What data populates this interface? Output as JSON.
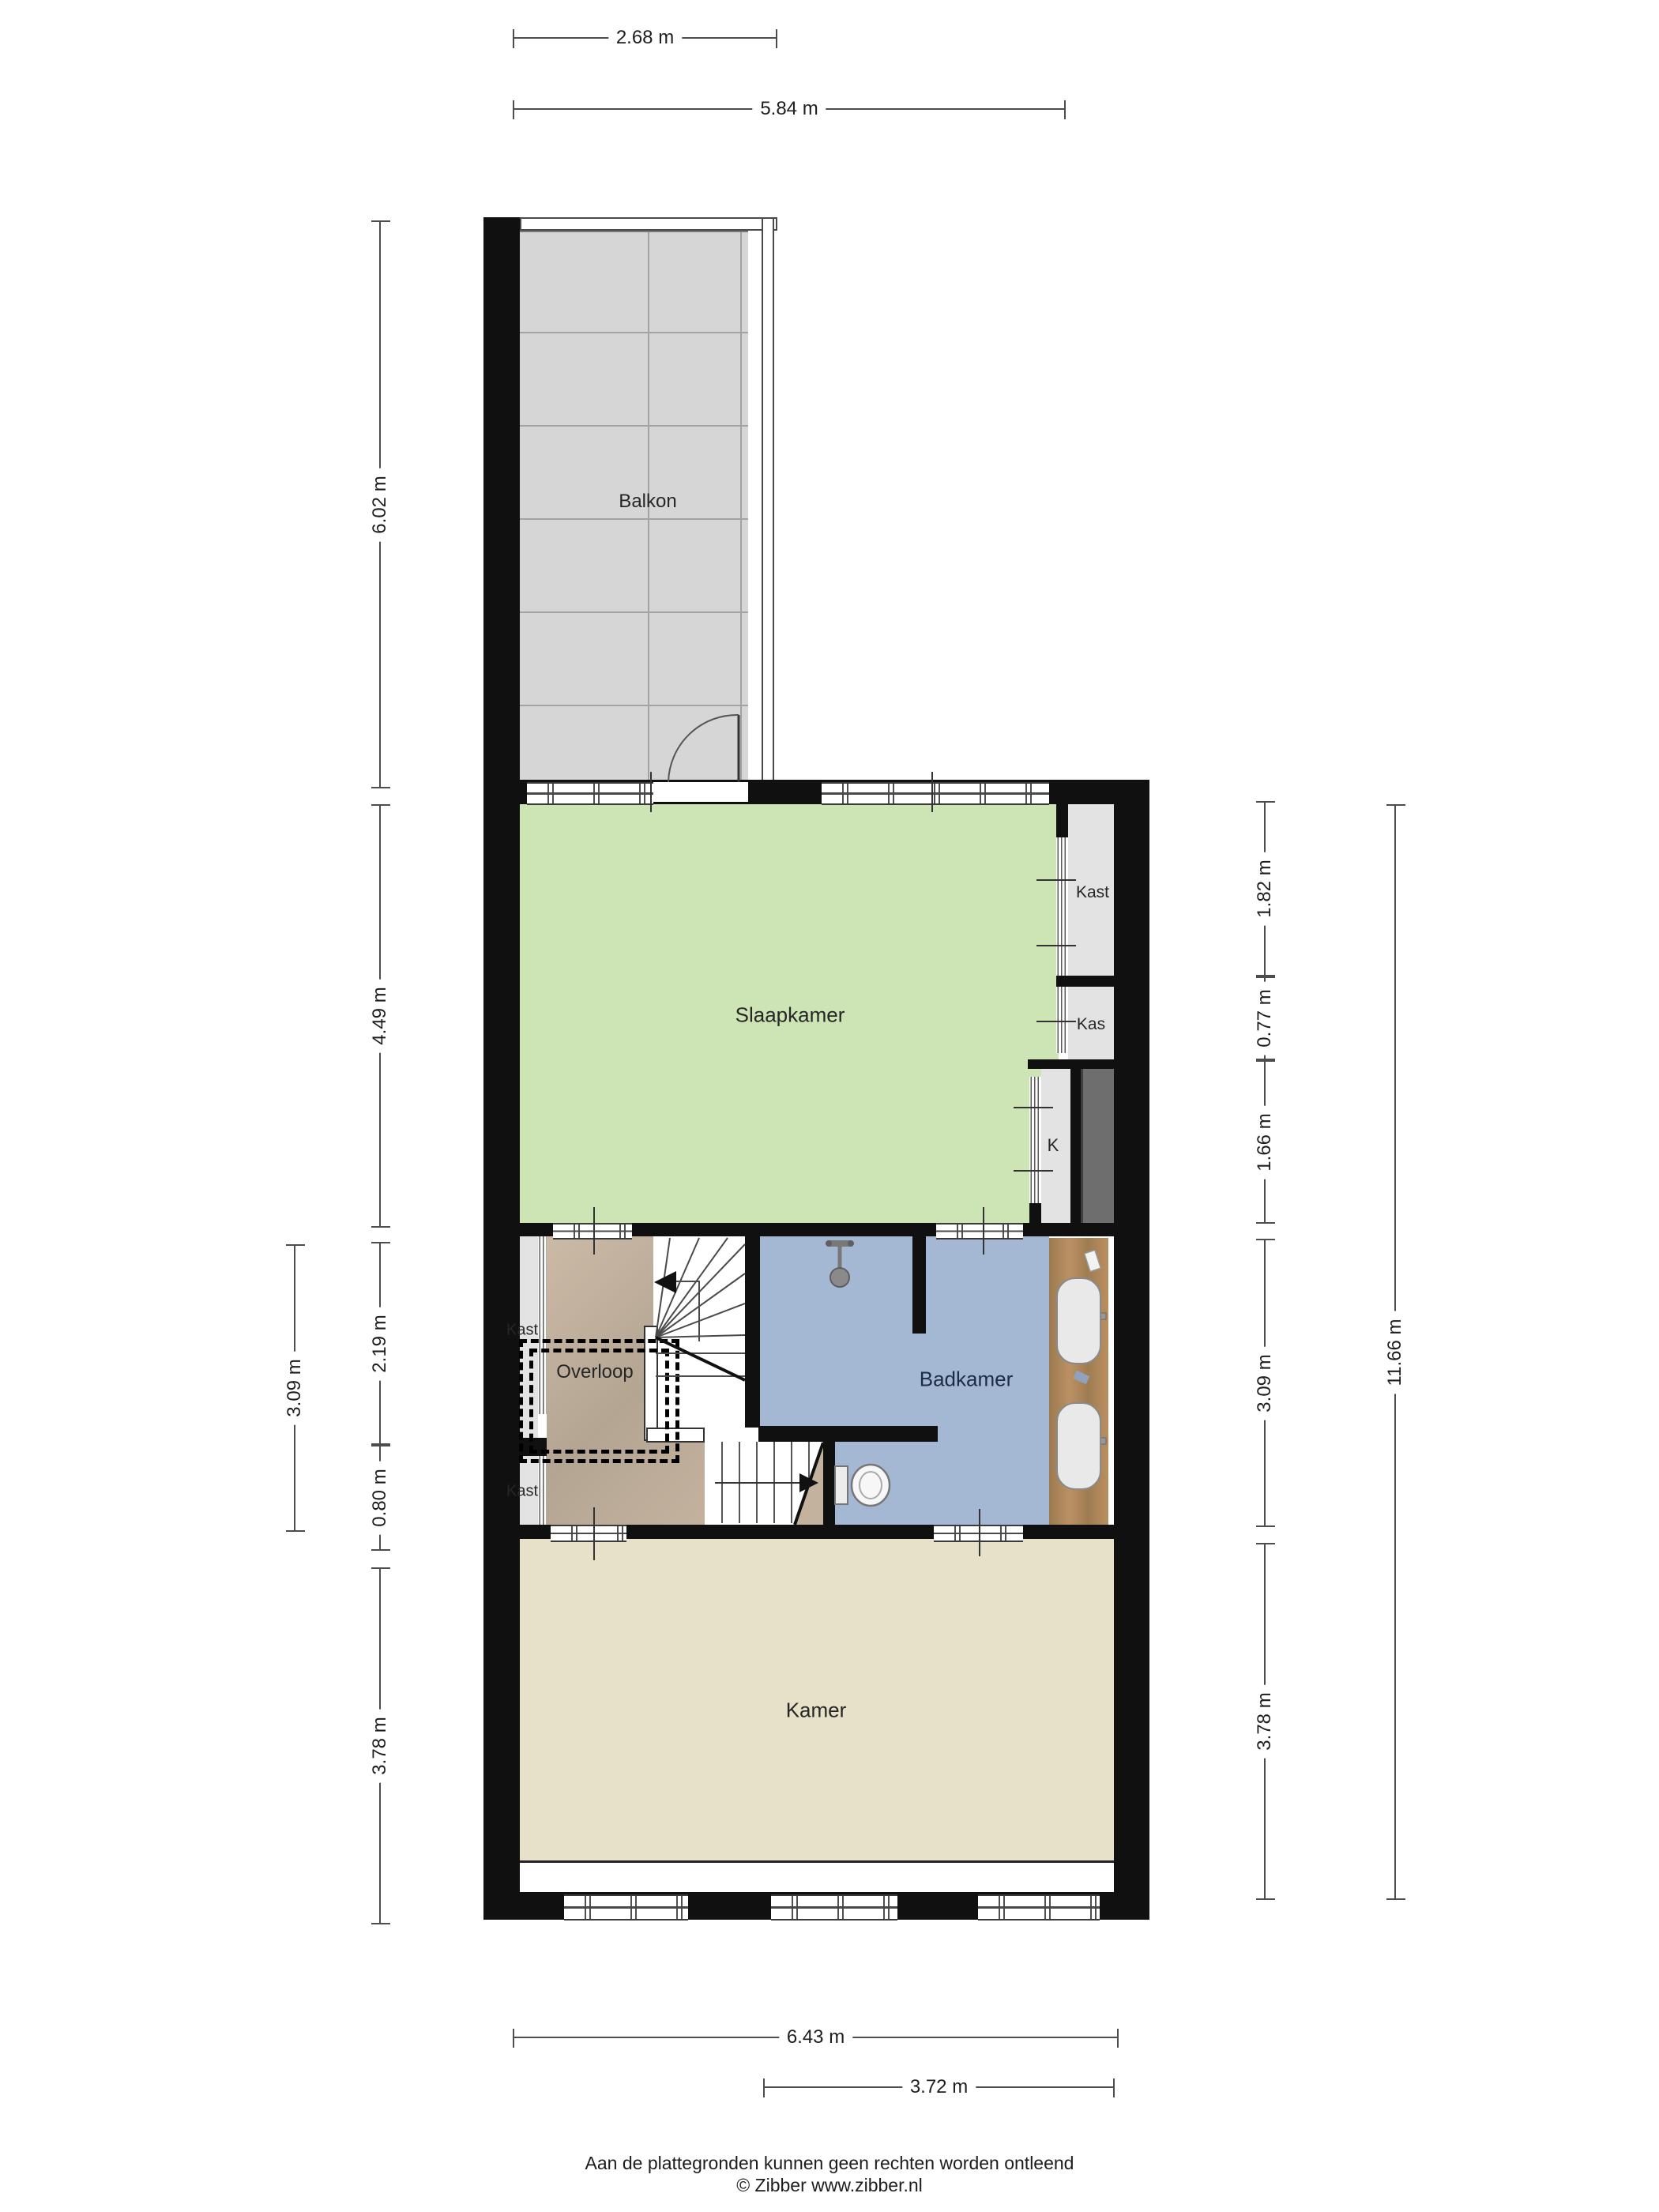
{
  "rooms": {
    "balkon": "Balkon",
    "slaapkamer": "Slaapkamer",
    "kast_top": "Kast",
    "kas": "Kas",
    "k": "K",
    "kast_mid_upper": "Kast",
    "kast_mid_lower": "Kast",
    "overloop": "Overloop",
    "badkamer": "Badkamer",
    "kamer": "Kamer"
  },
  "dimensions": {
    "top1": "2.68 m",
    "top2": "5.84 m",
    "bottom1": "6.43 m",
    "bottom2": "3.72 m",
    "left1": "6.02 m",
    "left2": "4.49 m",
    "left3": "2.19 m",
    "left4": "0.80 m",
    "left5": "3.78 m",
    "left_inner": "3.09 m",
    "right1": "1.82 m",
    "right2": "0.77 m",
    "right3": "1.66 m",
    "right4": "3.09 m",
    "right5": "3.78 m",
    "right_outer": "11.66 m"
  },
  "footer": {
    "line1": "Aan de plattegronden kunnen geen rechten worden ontleend",
    "line2": "© Zibber www.zibber.nl"
  },
  "colors": {
    "wall": "#101010",
    "bedroom_green": "#cde4b5",
    "bathroom_blue": "#a4b8d4",
    "landing_tan": "#c3b29e",
    "room_beige": "#e7e1ca",
    "closet_grey": "#e3e3e3",
    "balcony_grey": "#d6d6d6",
    "shaft_grey": "#6e6e6e",
    "vanity_wood": "#ab8558"
  }
}
